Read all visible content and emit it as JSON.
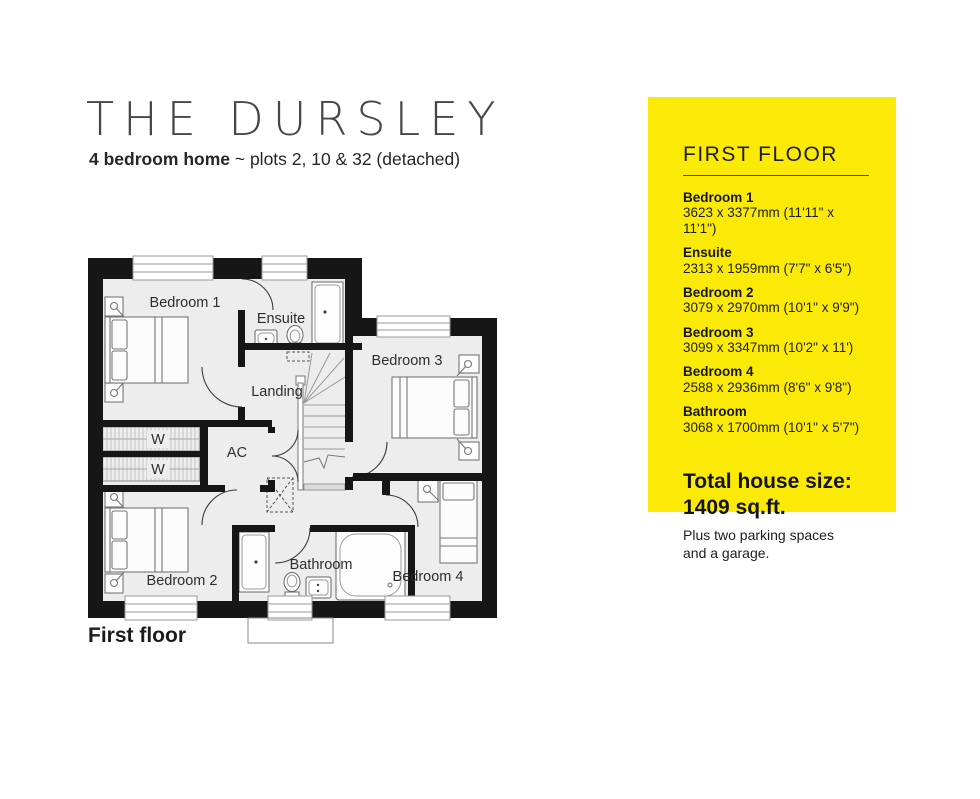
{
  "header": {
    "title": "THE DURSLEY",
    "subtitle_bold": "4 bedroom home",
    "subtitle_rest": " ~ plots 2, 10 & 32 (detached)"
  },
  "panel": {
    "heading": "FIRST FLOOR",
    "bg_color": "#FBEA07",
    "rooms": [
      {
        "name": "Bedroom 1",
        "dims": "3623 x 3377mm (11'11\" x 11'1\")"
      },
      {
        "name": "Ensuite",
        "dims": "2313 x 1959mm (7'7\" x 6'5\")"
      },
      {
        "name": "Bedroom 2",
        "dims": "3079 x 2970mm (10'1\" x 9'9\")"
      },
      {
        "name": "Bedroom 3",
        "dims": "3099 x 3347mm (10'2\" x 11')"
      },
      {
        "name": "Bedroom 4",
        "dims": "2588 x 2936mm (8'6\" x 9'8\")"
      },
      {
        "name": "Bathroom",
        "dims": "3068 x 1700mm (10'1\" x 5'7\")"
      }
    ],
    "total_line1": "Total house size:",
    "total_line2": "1409 sq.ft.",
    "note_line1": "Plus two parking spaces",
    "note_line2": "and a garage."
  },
  "plan": {
    "caption": "First floor",
    "labels": {
      "bedroom1": "Bedroom 1",
      "ensuite": "Ensuite",
      "bedroom3": "Bedroom 3",
      "landing": "Landing",
      "wardrobe": "W",
      "ac": "AC",
      "bedroom2": "Bedroom 2",
      "bathroom": "Bathroom",
      "bedroom4": "Bedroom 4"
    },
    "colors": {
      "wall": "#161616",
      "floor": "#EDEDEE"
    }
  }
}
